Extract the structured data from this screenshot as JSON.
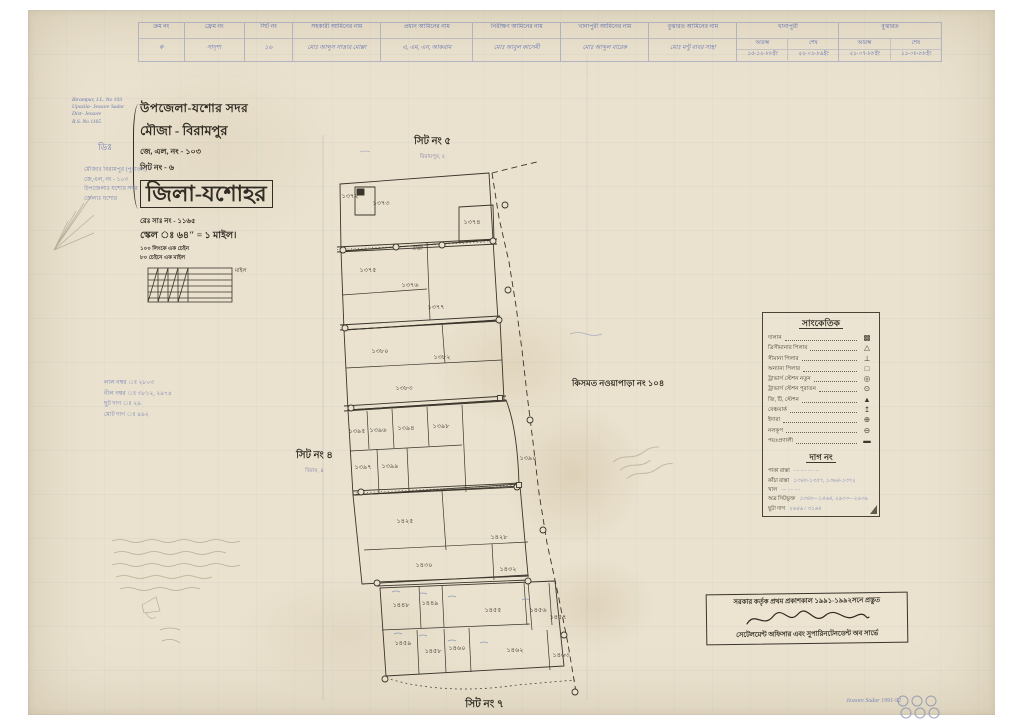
{
  "page": {
    "paper_color": "#eae2cf",
    "ink_black": "#3a352b",
    "ink_blue": "#5a6aae",
    "pencil": "#a89d86"
  },
  "header_table": {
    "columns": [
      {
        "label": "ক্রম নং",
        "value": "ক"
      },
      {
        "label": "ফ্রেম নং",
        "value": "সাদৃশ্য"
      },
      {
        "label": "সিট নং",
        "value": "১৬"
      },
      {
        "label": "সহকারী আমিনের নাম",
        "value": "মোঃ আব্দুস সাত্তার মোল্লা"
      },
      {
        "label": "প্রধান আমিনের নাম",
        "value": "এ, এম, এন, আকরাম"
      },
      {
        "label": "নিরীক্ষণ আমিনের নাম",
        "value": "মোঃ আবুল কাসেমী"
      },
      {
        "label": "খানাপুরী আমিনের নাম",
        "value": "মোঃ আব্দুল বারেক"
      },
      {
        "label": "বুঝারত আমিনের নাম",
        "value": "মোঃ মন্টু বাবর সাহা"
      },
      {
        "label": "খানাপুরী",
        "sub": [
          "আরম্ভ",
          "শেষ"
        ],
        "values": [
          "১৫-১২-৮৮ইং",
          "২২-০১-৮৯ইং"
        ]
      },
      {
        "label": "বুঝারত",
        "sub": [
          "আরম্ভ",
          "শেষ"
        ],
        "values": [
          "২১-০৭-৮৮ইং",
          "১১-০৮-৮৮ইং"
        ]
      }
    ]
  },
  "title_block": {
    "line1": "উপজেলা-যশোর সদর",
    "line2": "মৌজা - বিরামপুর",
    "line3": "জে, এল, নং - ১০৩",
    "line4": "সিট নং - ৬",
    "district": "জিলা-যশোহর"
  },
  "scale_block": {
    "rs_no": "রেঃ সাঃ নং - ১১৬৫",
    "scale": "স্কেল ঃ ৬৪″ = ১ মাইল।",
    "chain1": "১০০ লিংকে এক চেইন",
    "chain2": "৮০ চেইনে এক মাইল",
    "bar_label": "মাইল"
  },
  "sheet_labels": {
    "top": "সিট নং ৫",
    "top_sub": "বিরামপুর, ৫",
    "left": "সিট নং ৪",
    "left_sub": "বিরাম, ৪",
    "bottom": "সিট নং ৭"
  },
  "neighbor_label": "কিসমত নওয়াপাড়া নং ১০৪",
  "legend": {
    "title": "সাংকেতিক",
    "items": [
      {
        "label": "দালান",
        "symbol": "▩"
      },
      {
        "label": "ত্রিসীমানার পিলার",
        "symbol": "△"
      },
      {
        "label": "সীমানা পিলার",
        "symbol": "⊥"
      },
      {
        "label": "অন্যান্য পিলার",
        "symbol": "□"
      },
      {
        "label": "ট্রাভার্স স্টেশন নতুন",
        "symbol": "◎"
      },
      {
        "label": "ট্রাভার্স স্টেশন পুরাতন",
        "symbol": "⊙"
      },
      {
        "label": "জি, টি, স্টেশন",
        "symbol": "▲"
      },
      {
        "label": "বেঞ্চমার্ক",
        "symbol": "↥"
      },
      {
        "label": "ইদারা",
        "symbol": "⊕"
      },
      {
        "label": "নলকূপ",
        "symbol": "⊖"
      },
      {
        "label": "পয়ঃপ্রণালী",
        "symbol": "▬"
      }
    ],
    "dag": {
      "title": "দাগ নং",
      "rows": [
        {
          "label": "পাকা রাস্তা",
          "value": "···· ···· ···· ····"
        },
        {
          "label": "কাঁচা রাস্তা",
          "value": "১৩৪৮-১৩৫৭, ১৩৬৪-১৩৭২"
        },
        {
          "label": "খাল",
          "value": "···· ···· ····"
        },
        {
          "label": "অত্র সিটভুক্ত",
          "value": "১৩৪৮—১৪৬৪, ২৯০০—২৯৩৯"
        },
        {
          "label": "ছুটা দাগ",
          "value": "২৬৪৯ / ৩১৬৪"
        }
      ]
    }
  },
  "stamp": {
    "line1": "সরকার কর্তৃক প্রথম প্রকাশকাল ১৯৯১-১৯৯২সনে প্রস্তুত",
    "line2": "সেটেলমেন্ট অফিসার এবং সুপারিনটেনডেন্ট অব সার্ভে"
  },
  "notes": {
    "english": [
      "Birampur, J.L. No 103",
      "Upazila- Jessore Sadar",
      "Dist- Jessore",
      "R.S. No 1165"
    ],
    "mark": "ডিঃ",
    "blue_bn": [
      "মৌজাঃ বিরামপুর (পুরাতন)",
      "জে,এল, নং - ১০৩",
      "উপজেলাঃ যশোর সদর",
      "জেলাঃ যশোর"
    ],
    "left_mid": [
      "লাল নম্বর ঃ ২৮০৩",
      "নীল নম্বর ঃ ৩৮১২, ২৯৭৪",
      "ছুট দাগ ঃ ২৯",
      "মোট দাগ ঃ ৪৯২"
    ],
    "corner": "Jessore Sadar 1991-92"
  },
  "map": {
    "road_label": "রাস্তা",
    "plots": [
      {
        "n": "১৩৭২",
        "x": 350,
        "y": 198
      },
      {
        "n": "১৩৭৩",
        "x": 381,
        "y": 205
      },
      {
        "n": "১৩৭৪",
        "x": 472,
        "y": 224
      },
      {
        "n": "১৩৭৫",
        "x": 368,
        "y": 272
      },
      {
        "n": "১৩৭৬",
        "x": 410,
        "y": 287
      },
      {
        "n": "১৩৭৭",
        "x": 436,
        "y": 309
      },
      {
        "n": "১৩৮০",
        "x": 380,
        "y": 353
      },
      {
        "n": "১৩৮২",
        "x": 442,
        "y": 359
      },
      {
        "n": "১৩৮৩",
        "x": 404,
        "y": 390
      },
      {
        "n": "১৩৯৫",
        "x": 357,
        "y": 433
      },
      {
        "n": "১৩৯৬",
        "x": 378,
        "y": 432
      },
      {
        "n": "১৩৯৪",
        "x": 406,
        "y": 430
      },
      {
        "n": "১৩৯৮",
        "x": 441,
        "y": 428
      },
      {
        "n": "১৩৯৭",
        "x": 363,
        "y": 469
      },
      {
        "n": "১৩৯৯",
        "x": 390,
        "y": 468
      },
      {
        "n": "১৩৯০",
        "x": 528,
        "y": 460
      },
      {
        "n": "১৪২৫",
        "x": 405,
        "y": 523
      },
      {
        "n": "১৪২৮",
        "x": 499,
        "y": 539
      },
      {
        "n": "১৪৩০",
        "x": 424,
        "y": 567
      },
      {
        "n": "১৪৩২",
        "x": 508,
        "y": 571
      },
      {
        "n": "১৪৪৮",
        "x": 401,
        "y": 607
      },
      {
        "n": "১৪৪৯",
        "x": 430,
        "y": 605
      },
      {
        "n": "১৪৫৫",
        "x": 493,
        "y": 612
      },
      {
        "n": "১৪৫৬",
        "x": 538,
        "y": 612
      },
      {
        "n": "১৪৫৭",
        "x": 558,
        "y": 619
      },
      {
        "n": "১৪৫৯",
        "x": 403,
        "y": 645
      },
      {
        "n": "১৪৫৮",
        "x": 433,
        "y": 653
      },
      {
        "n": "১৪৬০",
        "x": 457,
        "y": 650
      },
      {
        "n": "১৪৬২",
        "x": 515,
        "y": 652
      },
      {
        "n": "১৪৬৩",
        "x": 561,
        "y": 657
      }
    ],
    "stations": [
      [
        343,
        250
      ],
      [
        396,
        247
      ],
      [
        442,
        245
      ],
      [
        493,
        241
      ],
      [
        505,
        205
      ],
      [
        345,
        328
      ],
      [
        499,
        320
      ],
      [
        351,
        408
      ],
      [
        361,
        492
      ],
      [
        517,
        487
      ],
      [
        377,
        583
      ],
      [
        528,
        581
      ],
      [
        385,
        679
      ],
      [
        508,
        290
      ],
      [
        530,
        420
      ],
      [
        543,
        530
      ],
      [
        564,
        635
      ],
      [
        575,
        692
      ]
    ],
    "squares": [
      [
        500,
        398
      ],
      [
        519,
        485
      ]
    ]
  }
}
